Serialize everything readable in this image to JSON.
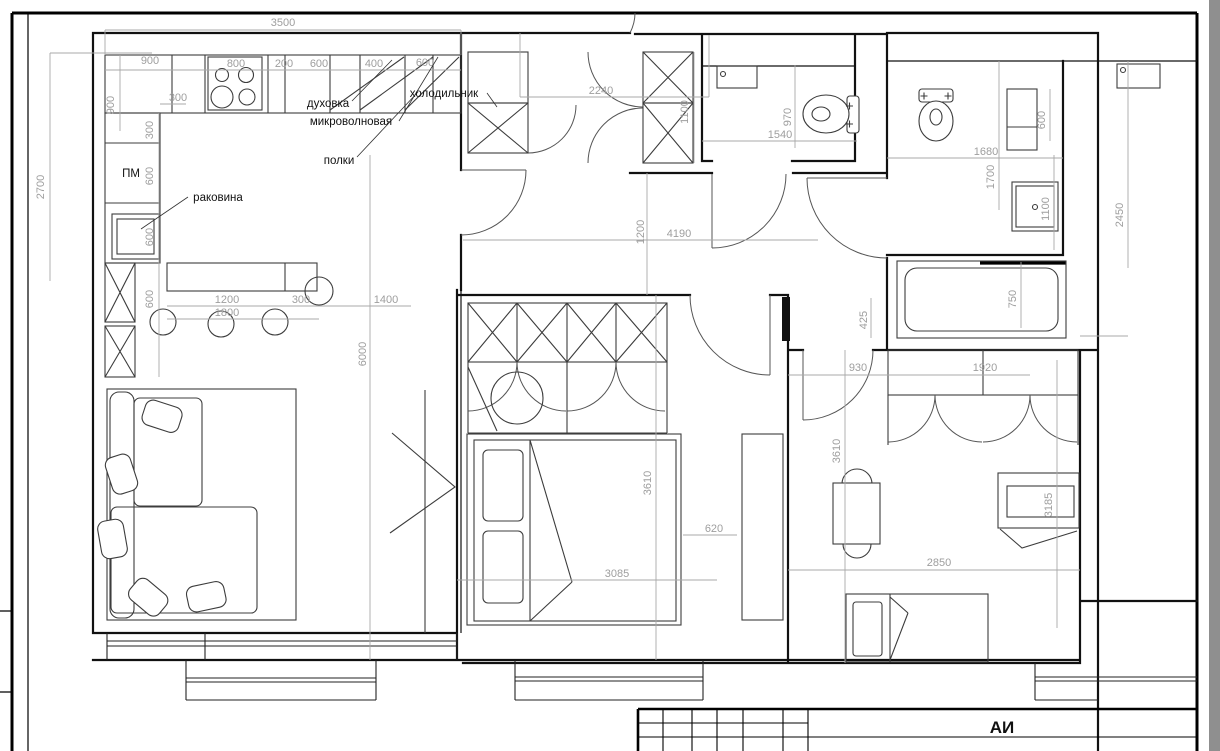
{
  "sheet": {
    "stamp_code": "АИ"
  },
  "labels": {
    "oven": "духовка",
    "microwave": "микроволновая",
    "shelves": "полки",
    "dishwasher": "ПМ",
    "sink": "раковина",
    "fridge": "холодильник"
  },
  "dimensions": [
    {
      "t": "3500"
    },
    {
      "t": "900"
    },
    {
      "t": "800"
    },
    {
      "t": "200"
    },
    {
      "t": "600"
    },
    {
      "t": "400"
    },
    {
      "t": "600"
    },
    {
      "t": "300"
    },
    {
      "t": "900"
    },
    {
      "t": "300"
    },
    {
      "t": "600"
    },
    {
      "t": "600"
    },
    {
      "t": "600"
    },
    {
      "t": "2700"
    },
    {
      "t": "1200"
    },
    {
      "t": "1800"
    },
    {
      "t": "300"
    },
    {
      "t": "1400"
    },
    {
      "t": "6000"
    },
    {
      "t": "2240"
    },
    {
      "t": "1100"
    },
    {
      "t": "1200"
    },
    {
      "t": "4190"
    },
    {
      "t": "970"
    },
    {
      "t": "1540"
    },
    {
      "t": "1680"
    },
    {
      "t": "1700"
    },
    {
      "t": "600"
    },
    {
      "t": "1100"
    },
    {
      "t": "2450"
    },
    {
      "t": "750"
    },
    {
      "t": "425"
    },
    {
      "t": "930"
    },
    {
      "t": "1920"
    },
    {
      "t": "3610"
    },
    {
      "t": "620"
    },
    {
      "t": "3085"
    },
    {
      "t": "3610"
    },
    {
      "t": "2850"
    },
    {
      "t": "3185"
    }
  ],
  "colors": {
    "walls": "#111111",
    "dimensions": "#9e9e9e",
    "canvas_edge": "#8f8f8f",
    "paper": "#ffffff"
  }
}
